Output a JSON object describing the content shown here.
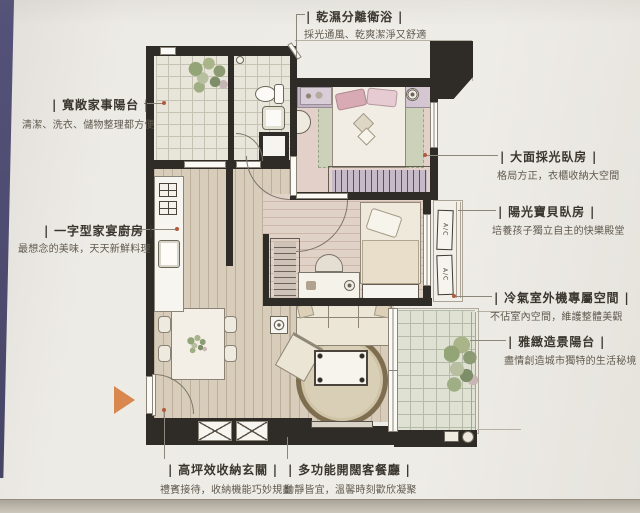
{
  "callouts": {
    "bathroom": {
      "title": "| 乾濕分離衛浴 |",
      "subtitle": "採光通風、乾爽潔淨又舒適"
    },
    "service_balcony": {
      "title": "| 寬敞家事陽台 |",
      "subtitle": "清潔、洗衣、儲物整理都方便"
    },
    "kitchen": {
      "title": "| 一字型家宴廚房 |",
      "subtitle": "最想念的美味，天天新鮮料理"
    },
    "master_bedroom": {
      "title": "| 大面採光臥房 |",
      "subtitle": "格局方正，衣櫃收納大空間"
    },
    "kids_bedroom": {
      "title": "| 陽光寶貝臥房 |",
      "subtitle": "培養孩子獨立自主的快樂殿堂"
    },
    "ac_space": {
      "title": "| 冷氣室外機專屬空間 |",
      "subtitle": "不佔室內空間，維護整體美觀"
    },
    "scenic_balcony": {
      "title": "| 雅緻造景陽台 |",
      "subtitle": "盡情創造城市獨特的生活秘境"
    },
    "foyer": {
      "title": "| 高坪效收納玄關 |",
      "subtitle": "禮賓接待，收納機能巧妙規劃"
    },
    "living_dining": {
      "title": "| 多功能開闊客餐廳 |",
      "subtitle": "動靜皆宜，溫馨時刻歡欣凝聚"
    }
  },
  "plan": {
    "ac_unit_label": "A/C",
    "colors": {
      "wall": "#2f2c27",
      "entry_arrow": "#d8874e",
      "leader_dot": "#b25a3e",
      "master_headboard": "#c6b6c6",
      "master_rug": "#ccd2ba",
      "pillow_pink": "#d8aab4",
      "wood_floor": "#d8cdba",
      "tile_floor": "#e8e5da"
    }
  }
}
